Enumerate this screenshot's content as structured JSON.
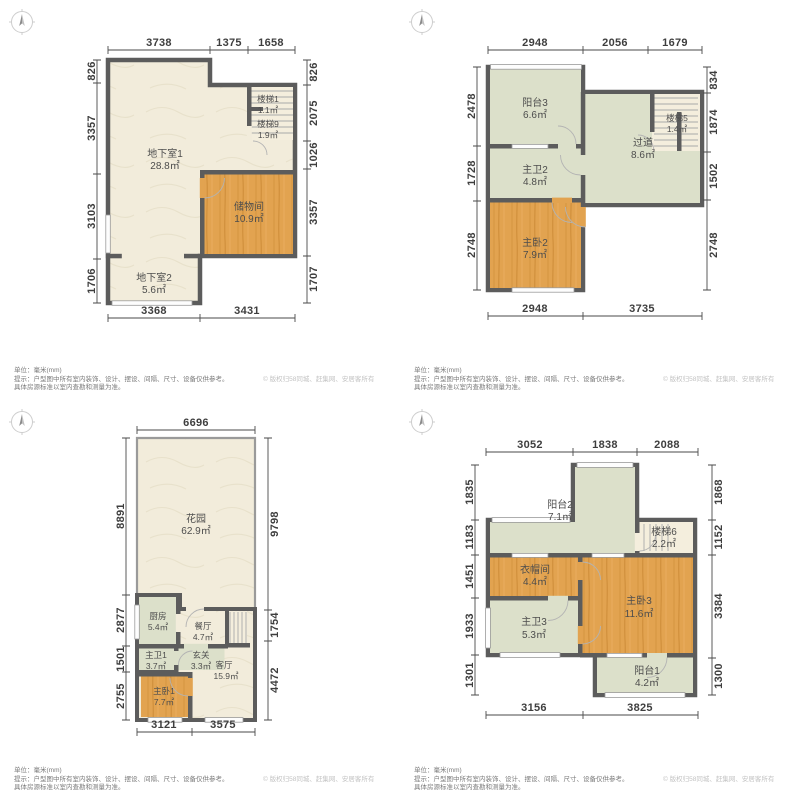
{
  "colors": {
    "wall": "#5c5c5c",
    "floor_beige": "#f2ecdb",
    "room_green": "#dce0ca",
    "room_orange_wood": "#e2a350",
    "stair_floor": "#f4eedd",
    "dim_text": "#3e3e3e",
    "footer_text": "#7a7a7a",
    "copyright_text": "#c3c3c3"
  },
  "footer": {
    "unit": "单位：毫米(mm)",
    "hint1": "提示：户型图中所有室内装饰、设计、摆设、间隔、尺寸、设备仅供参考。",
    "hint2": "具体房源标准以室内查勘和测量为准。",
    "copyright": "© 版权归58同城、赶集网、安居客所有"
  },
  "plans": [
    {
      "id": "basement",
      "dims": {
        "top": [
          "3738",
          "1375",
          "1658"
        ],
        "left": [
          "826",
          "3357",
          "3103",
          "1706"
        ],
        "right": [
          "826",
          "2075",
          "1026",
          "3357",
          "1707"
        ],
        "bottom": [
          "3368",
          "3431"
        ]
      },
      "rooms": [
        {
          "name": "地下室1",
          "area": "28.8㎡"
        },
        {
          "name": "储物间",
          "area": "10.9㎡"
        },
        {
          "name": "地下室2",
          "area": "5.6㎡"
        },
        {
          "name": "楼梯1",
          "area": "1.1㎡"
        },
        {
          "name": "楼梯9",
          "area": "1.9㎡"
        }
      ]
    },
    {
      "id": "level-2",
      "dims": {
        "top": [
          "2948",
          "2056",
          "1679"
        ],
        "left": [
          "2478",
          "1728",
          "2748"
        ],
        "right": [
          "834",
          "1874",
          "1502",
          "2748"
        ],
        "bottom": [
          "2948",
          "3735"
        ]
      },
      "rooms": [
        {
          "name": "阳台3",
          "area": "6.6㎡"
        },
        {
          "name": "主卫2",
          "area": "4.8㎡"
        },
        {
          "name": "主卧2",
          "area": "7.9㎡"
        },
        {
          "name": "过道",
          "area": "8.6㎡"
        },
        {
          "name": "楼梯5",
          "area": "1.4㎡"
        }
      ]
    },
    {
      "id": "ground",
      "dims": {
        "top": [
          "6696"
        ],
        "left": [
          "8891",
          "2877",
          "1501",
          "2755"
        ],
        "right": [
          "9798",
          "1754",
          "4472"
        ],
        "bottom": [
          "3121",
          "3575"
        ]
      },
      "rooms": [
        {
          "name": "花园",
          "area": "62.9㎡"
        },
        {
          "name": "厨房",
          "area": "5.4㎡"
        },
        {
          "name": "餐厅",
          "area": "4.7㎡"
        },
        {
          "name": "主卫1",
          "area": "3.7㎡"
        },
        {
          "name": "玄关",
          "area": "3.3㎡"
        },
        {
          "name": "客厅",
          "area": "15.9㎡"
        },
        {
          "name": "主卧1",
          "area": "7.7㎡"
        }
      ]
    },
    {
      "id": "level-3",
      "dims": {
        "top": [
          "3052",
          "1838",
          "2088"
        ],
        "left": [
          "1835",
          "1183",
          "1451",
          "1933",
          "1301"
        ],
        "right": [
          "1868",
          "1152",
          "3384",
          "1300"
        ],
        "bottom": [
          "3156",
          "3825"
        ]
      },
      "rooms": [
        {
          "name": "阳台2",
          "area": "7.1㎡"
        },
        {
          "name": "楼梯6",
          "area": "2.2㎡"
        },
        {
          "name": "衣帽间",
          "area": "4.4㎡"
        },
        {
          "name": "主卧3",
          "area": "11.6㎡"
        },
        {
          "name": "主卫3",
          "area": "5.3㎡"
        },
        {
          "name": "阳台1",
          "area": "4.2㎡"
        }
      ]
    }
  ]
}
